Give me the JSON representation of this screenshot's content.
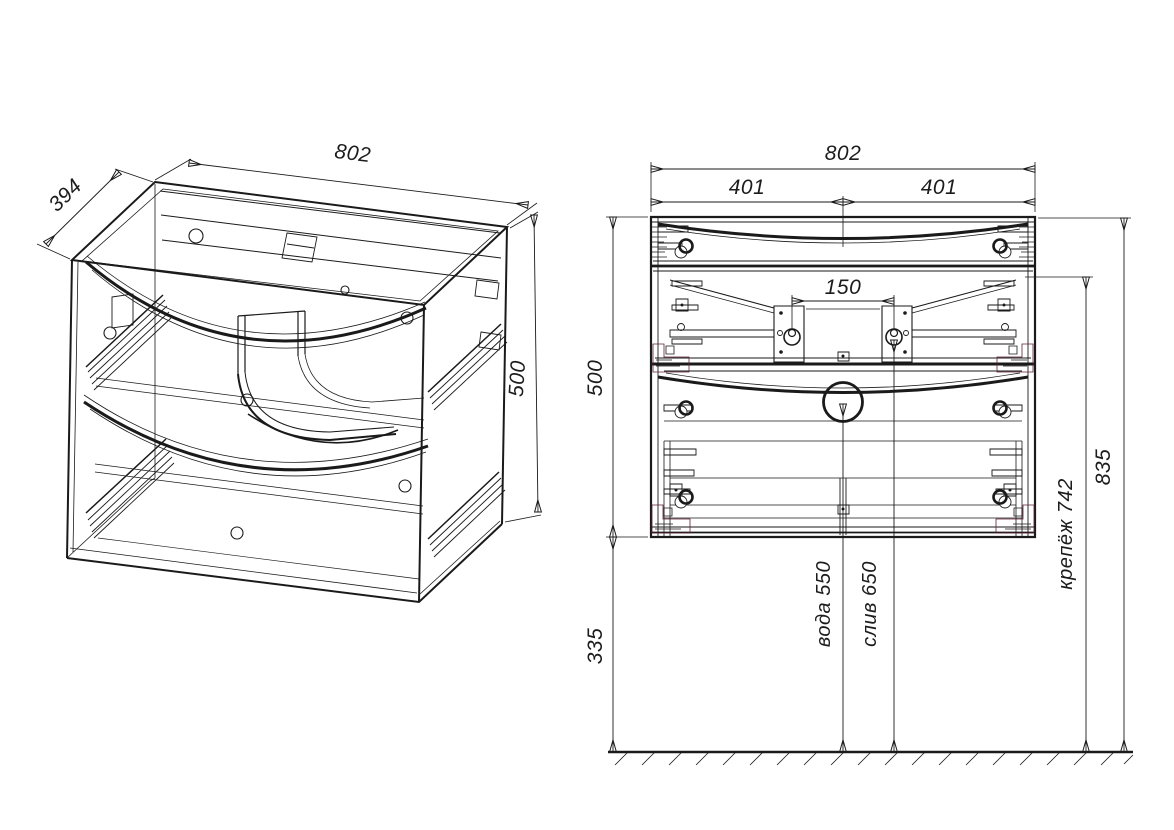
{
  "iso": {
    "width": "802",
    "depth": "394",
    "height": "500"
  },
  "front": {
    "width": "802",
    "left_half": "401",
    "right_half": "401",
    "bracket_spacing": "150",
    "cabinet_height": "500",
    "floor_clearance": "335",
    "overall_height": "835",
    "mounting": "крепёж 742",
    "water": "вода 550",
    "drain": "слив 650"
  },
  "colors": {
    "line": "#1a1a1a",
    "hardware_purple": "#7a1f7e",
    "bracket_maroon": "#a2606e"
  }
}
